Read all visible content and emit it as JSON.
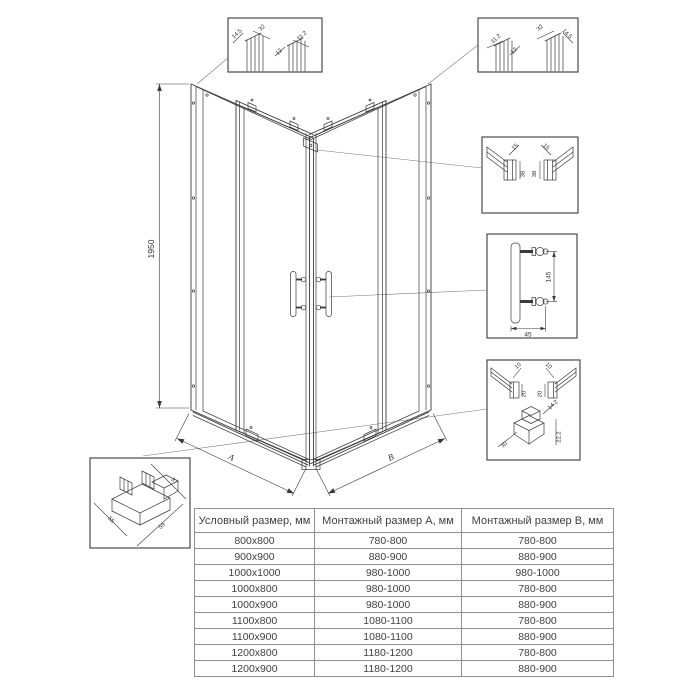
{
  "drawing": {
    "height_label": "1950",
    "dim_a_label": "A",
    "dim_b_label": "B"
  },
  "details": {
    "top_left_profile": {
      "labels": [
        "14.5",
        "32",
        "12",
        "31.2"
      ]
    },
    "top_right_profile": {
      "labels": [
        "31.2",
        "12",
        "32",
        "14.5"
      ]
    },
    "wall_profile": {
      "labels": [
        "15",
        "38",
        "38",
        "15"
      ]
    },
    "handle": {
      "height": "145",
      "depth": "45"
    },
    "bottom_corner": {
      "labels": [
        "10",
        "20",
        "10",
        "20",
        "14.2",
        "22.2",
        "30"
      ]
    },
    "corner_connector": {
      "labels": [
        "37",
        "55",
        "59"
      ]
    }
  },
  "table": {
    "headers": [
      "Условный размер, мм",
      "Монтажный размер А, мм",
      "Монтажный размер В, мм"
    ],
    "rows": [
      [
        "800x800",
        "780-800",
        "780-800"
      ],
      [
        "900x900",
        "880-900",
        "880-900"
      ],
      [
        "1000x1000",
        "980-1000",
        "980-1000"
      ],
      [
        "1000x800",
        "980-1000",
        "780-800"
      ],
      [
        "1000x900",
        "980-1000",
        "880-900"
      ],
      [
        "1100x800",
        "1080-1100",
        "780-800"
      ],
      [
        "1100x900",
        "1080-1100",
        "880-900"
      ],
      [
        "1200x800",
        "1180-1200",
        "780-800"
      ],
      [
        "1200x900",
        "1180-1200",
        "880-900"
      ]
    ]
  }
}
